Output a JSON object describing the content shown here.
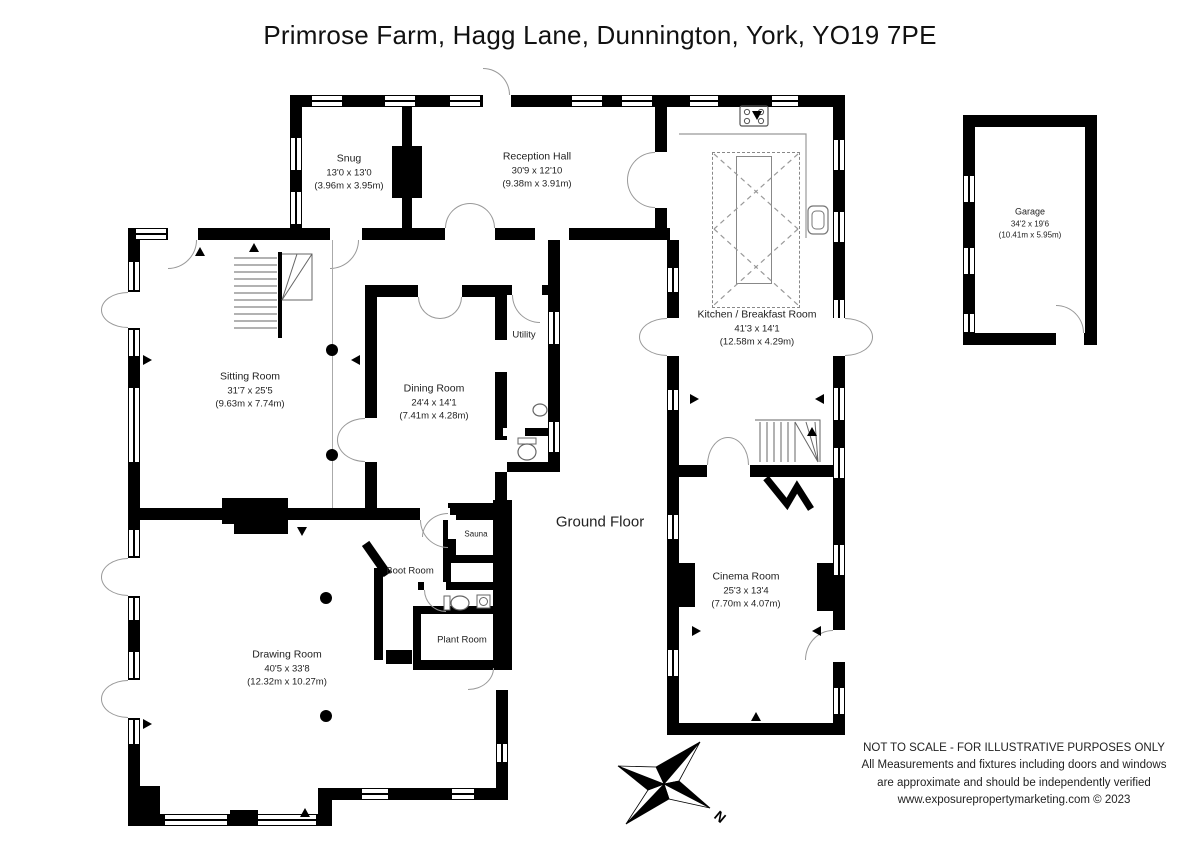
{
  "title": "Primrose Farm, Hagg Lane, Dunnington, York, YO19 7PE",
  "floor_label": "Ground Floor",
  "compass_north_label": "N",
  "disclaimer": {
    "line1": "NOT TO SCALE - FOR ILLUSTRATIVE PURPOSES ONLY",
    "line2": "All Measurements and fixtures including doors and windows",
    "line3": "are approximate and should be independently verified",
    "line4": "www.exposurepropertymarketing.com © 2023"
  },
  "rooms": {
    "snug": {
      "name": "Snug",
      "imperial": "13'0 x 13'0",
      "metric": "(3.96m x 3.95m)"
    },
    "reception_hall": {
      "name": "Reception Hall",
      "imperial": "30'9 x 12'10",
      "metric": "(9.38m x 3.91m)"
    },
    "kitchen": {
      "name": "Kitchen / Breakfast Room",
      "imperial": "41'3 x 14'1",
      "metric": "(12.58m x 4.29m)"
    },
    "sitting_room": {
      "name": "Sitting Room",
      "imperial": "31'7 x 25'5",
      "metric": "(9.63m x 7.74m)"
    },
    "dining_room": {
      "name": "Dining Room",
      "imperial": "24'4 x 14'1",
      "metric": "(7.41m x 4.28m)"
    },
    "utility": {
      "name": "Utility"
    },
    "garage": {
      "name": "Garage",
      "imperial": "34'2 x 19'6",
      "metric": "(10.41m x 5.95m)"
    },
    "sauna": {
      "name": "Sauna"
    },
    "boot_room": {
      "name": "Boot Room"
    },
    "plant_room": {
      "name": "Plant Room"
    },
    "drawing_room": {
      "name": "Drawing Room",
      "imperial": "40'5 x 33'8",
      "metric": "(12.32m x 10.27m)"
    },
    "cinema_room": {
      "name": "Cinema Room",
      "imperial": "25'3 x 13'4",
      "metric": "(7.70m x 4.07m)"
    }
  },
  "colors": {
    "wall": "#000000",
    "door_line": "#999999",
    "background": "#ffffff"
  }
}
